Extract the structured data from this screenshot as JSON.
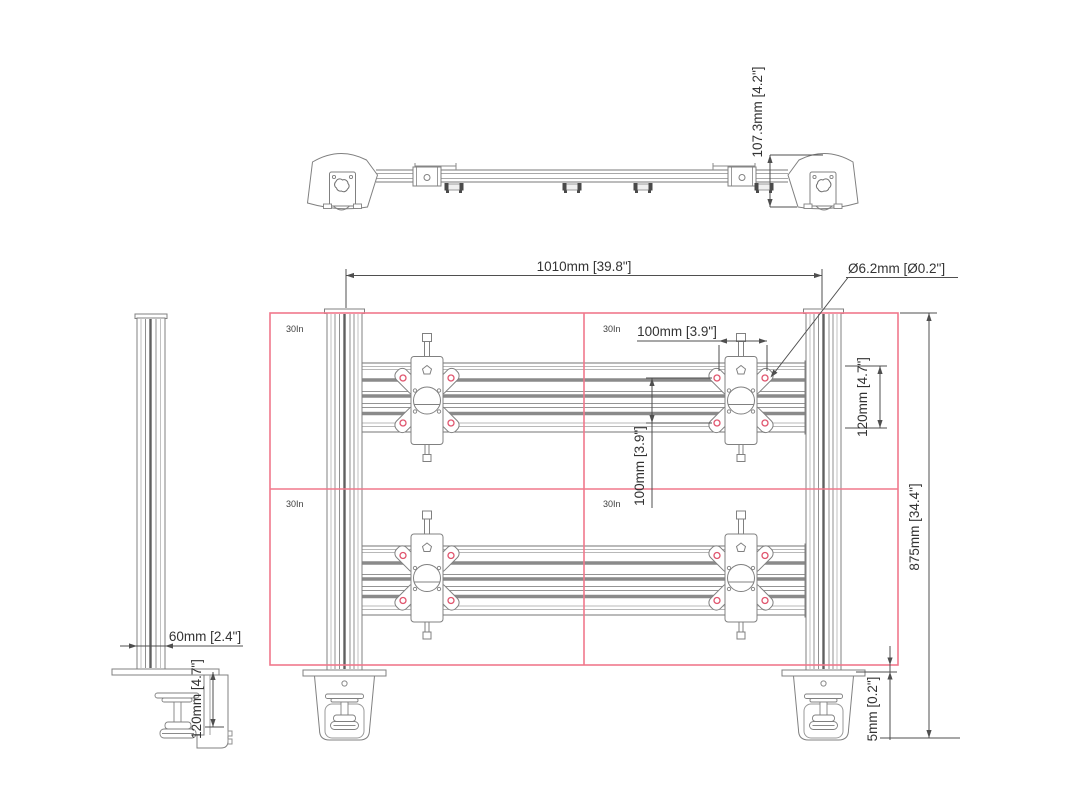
{
  "front_view": {
    "monitors": [
      {
        "label": "30In"
      },
      {
        "label": "30In"
      },
      {
        "label": "30In"
      },
      {
        "label": "30In"
      }
    ],
    "dims": {
      "overall_width": "1010mm [39.8\"]",
      "hole_diameter": "Ø6.2mm [Ø0.2\"]",
      "vesa_width": "100mm [3.9\"]",
      "vesa_height": "100mm [3.9\"]",
      "rail_height": "120mm [4.7\"]",
      "overall_height": "875mm [34.4\"]",
      "desk_gap": "5mm [0.2\"]"
    }
  },
  "top_view": {
    "dims": {
      "depth": "107.3mm [4.2\"]"
    }
  },
  "side_view": {
    "dims": {
      "pole_width": "60mm [2.4\"]",
      "clamp_height": "120mm [4.7\"]"
    }
  },
  "colors": {
    "accent_red": "#f0788c",
    "hole_red": "#e0556e",
    "line": "#808080",
    "dark_line": "#606060",
    "text": "#333333",
    "background": "#ffffff"
  }
}
